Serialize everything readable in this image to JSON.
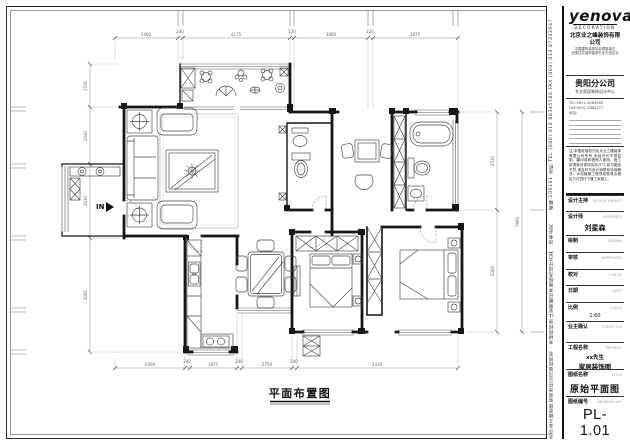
{
  "drawing": {
    "plan_label": "平面布置图",
    "entry_label": "IN",
    "dims": {
      "top": [
        "2460",
        "240",
        "4175",
        "120",
        "3060",
        "220",
        "1875"
      ],
      "bottom": [
        "2400",
        "240",
        "1875",
        "240",
        "2750",
        "240",
        "3410"
      ],
      "left": [
        "1530",
        "2040",
        "2630",
        "4060"
      ],
      "right": [
        "3530",
        "4360"
      ],
      "right_overall": "7960"
    }
  },
  "title_block": {
    "logo": {
      "brand": "yenova",
      "sub": "DECORATION"
    },
    "company": "北京业之峰装饰有限公司",
    "company_sub1": "中国建筑装饰协会理事单位",
    "company_sub2": "全国住宅装饰装修行业先进企业",
    "branch": "贵阳分公司",
    "branch_sub": "专业家居装饰设计中心",
    "tel_line": "TEL:0851-5864566    FAX:0851-5864577",
    "addr_line": "地址:",
    "notes": "注:本图纸版权归北京业之峰装饰有限公司所有,未经许可不得复制、翻印或转借他人使用。施工前请核对现场实际尺寸,如与图纸不符,请及时与设计师联系协商解决。水电隐蔽工程须经验收合格后方可进行下道工序施工。",
    "rows": [
      {
        "cn": "设计主持",
        "en": "DESIGN DIRECT"
      },
      {
        "cn": "设计师",
        "en": "DESIGNER",
        "value": "刘星森"
      },
      {
        "cn": "绘制",
        "en": "DRAWN"
      },
      {
        "cn": "审核",
        "en": "APPROVED"
      },
      {
        "cn": "校对",
        "en": "CHECK"
      },
      {
        "cn": "日期",
        "en": "DATE"
      },
      {
        "cn": "比例",
        "en": "SCALE",
        "value": "1:60"
      },
      {
        "cn": "业主确认",
        "en": "TUENTITLE"
      },
      {
        "cn": "工程名称",
        "en": "PROJECT",
        "value1": "xx先生",
        "value2": "家居装饰图"
      },
      {
        "cn": "图纸名称",
        "en": "TITLE",
        "value": "原始平面图"
      },
      {
        "cn": "图纸编号",
        "en": "DRAWING NO",
        "value": "PL-1.01"
      }
    ],
    "side_top": "邮编:100101  总机 TEL (060) 010 88345566  FAX (060) 010 87232547",
    "side_bottom": "北京业之峰装饰有限责任公司版权所有 · 未经授权禁止复制翻印本图纸及设计方案 · 违者必究"
  }
}
